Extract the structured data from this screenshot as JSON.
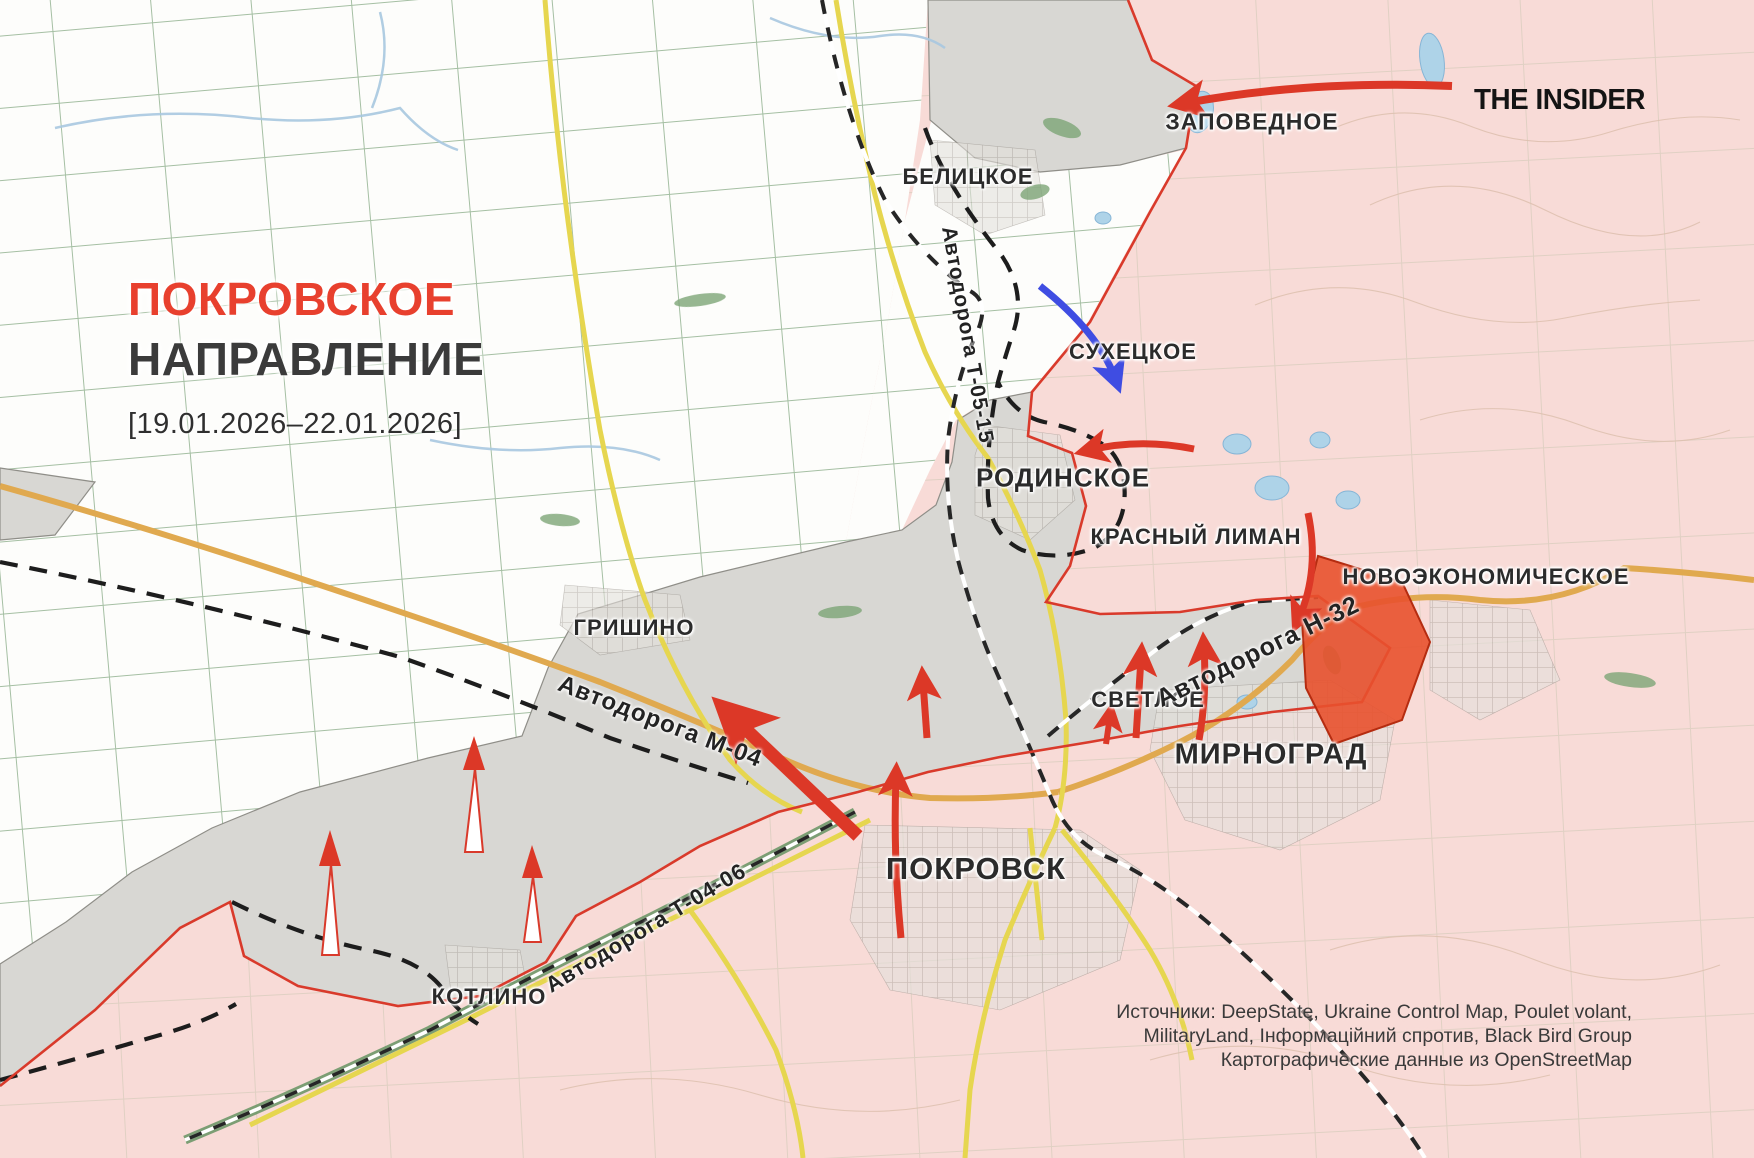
{
  "title": {
    "heading_red": "ПОКРОВСКОЕ",
    "heading_dark": "НАПРАВЛЕНИЕ",
    "date_range": "[19.01.2026–22.01.2026]"
  },
  "branding": {
    "logo_text": "THE INSIDER"
  },
  "settlements": [
    {
      "id": "zapovednoye",
      "label": "ЗАПОВЕДНОЕ"
    },
    {
      "id": "belitskoye",
      "label": "БЕЛИЦКОЕ"
    },
    {
      "id": "sukhetskoye",
      "label": "СУХЕЦКОЕ"
    },
    {
      "id": "rodinskoye",
      "label": "РОДИНСКОЕ"
    },
    {
      "id": "krasny-liman",
      "label": "КРАСНЫЙ ЛИМАН"
    },
    {
      "id": "novoekonomicheskoye",
      "label": "НОВОЭКОНОМИЧЕСКОЕ"
    },
    {
      "id": "grishino",
      "label": "ГРИШИНО"
    },
    {
      "id": "svetloye",
      "label": "СВЕТЛОЕ"
    },
    {
      "id": "mirnograd",
      "label": "МИРНОГРАД"
    },
    {
      "id": "pokrovsk",
      "label": "ПОКРОВСК"
    },
    {
      "id": "kotlino",
      "label": "КОТЛИНО"
    }
  ],
  "roads": [
    {
      "id": "t-05-15",
      "label": "Автодорога Т-05-15"
    },
    {
      "id": "m-04",
      "label": "Автодорога М-04"
    },
    {
      "id": "n-32",
      "label": "Автодорога Н-32"
    },
    {
      "id": "t-04-06",
      "label": "Автодорога Т-04-06"
    }
  ],
  "sources": {
    "line1": "Источники: DeepState, Ukraine Control Map, Poulet volant,",
    "line2": "MilitaryLand, Інформаційний спротив, Black Bird Group",
    "line3": "Картографические данные из OpenStreetMap"
  },
  "legend": {
    "russian_controlled_fill": "#f8dbd7",
    "contested_fill": "#d8d7d3",
    "ukrainian_controlled_fill": "#fdfdfb",
    "recent_advance_fill": "#e8512e",
    "attack_arrow_color": "#dc3827",
    "counterattack_arrow_color": "#3f4de2",
    "frontline_color": "#d93a2b",
    "title_accent_color": "#e8402e"
  }
}
